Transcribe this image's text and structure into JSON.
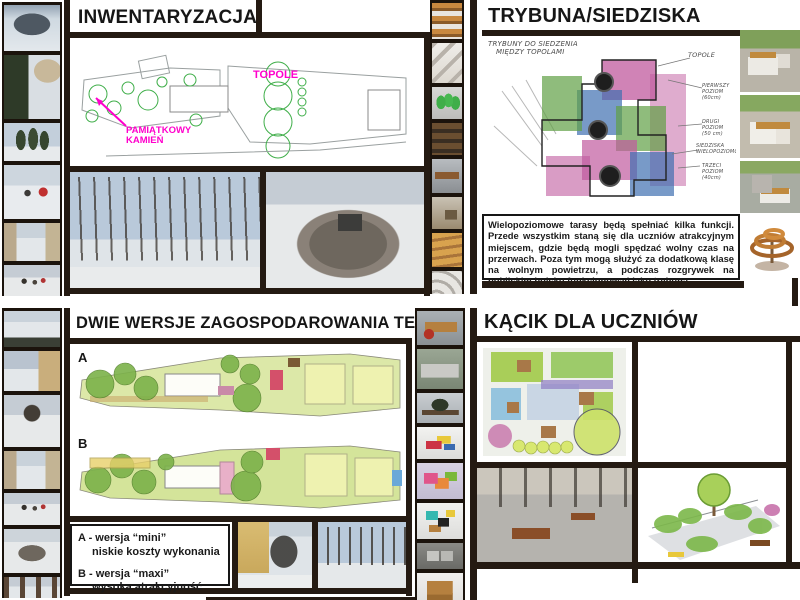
{
  "sections": {
    "top_left": {
      "title": "INWENTARYZACJA",
      "plan": {
        "label_topole": "TOPOLE",
        "label_kamien_line1": "PAMIĄTKOWY",
        "label_kamien_line2": "KAMIEŃ"
      }
    },
    "top_right": {
      "title": "TRYBUNA/SIEDZISKA",
      "sketch_notes": {
        "main_line1": "TRYBUNY DO SIEDZENIA",
        "main_line2": "MIĘDZY TOPOLAMI",
        "topole": "TOPOLE",
        "note1": "PIERWSZY POZIOM (60cm)",
        "note2": "DRUGI POZIOM (50 cm)",
        "note3": "SIEDZISKA WIELOPOZIOMOWE",
        "note4": "TRZECI POZIOM (40cm)"
      },
      "description": "Wielopoziomowe tarasy będą spełniać kilka funkcji. Przede wszystkim staną się dla uczniów atrakcyjnym miejscem, gdzie będą mogli spędzać wolny czas na przerwach. Poza tym mogą służyć za dodatkową klasę na wolnym powietrzu, a podczas rozgrywek na pobliskim boisku funkcjonować jako trybuna."
    },
    "bottom_left": {
      "title": "DWIE WERSJE ZAGOSPODAROWANIA TERENU",
      "plan_a_label": "A",
      "plan_b_label": "B",
      "captions": {
        "a1": "A - wersja “mini”",
        "a2": "niskie koszty wykonania",
        "b1": "B - wersja “maxi”",
        "b2": "wysoka atrakcyjność"
      }
    },
    "bottom_right": {
      "title": "KĄCIK DLA UCZNIÓW"
    }
  },
  "colors": {
    "frame": "#241a12",
    "label_magenta": "#ff00cc",
    "tree_green": "#3fae49",
    "sketch_magenta": "#c05a9e",
    "sketch_green": "#5fa045",
    "sketch_blue": "#3f6fb0"
  }
}
